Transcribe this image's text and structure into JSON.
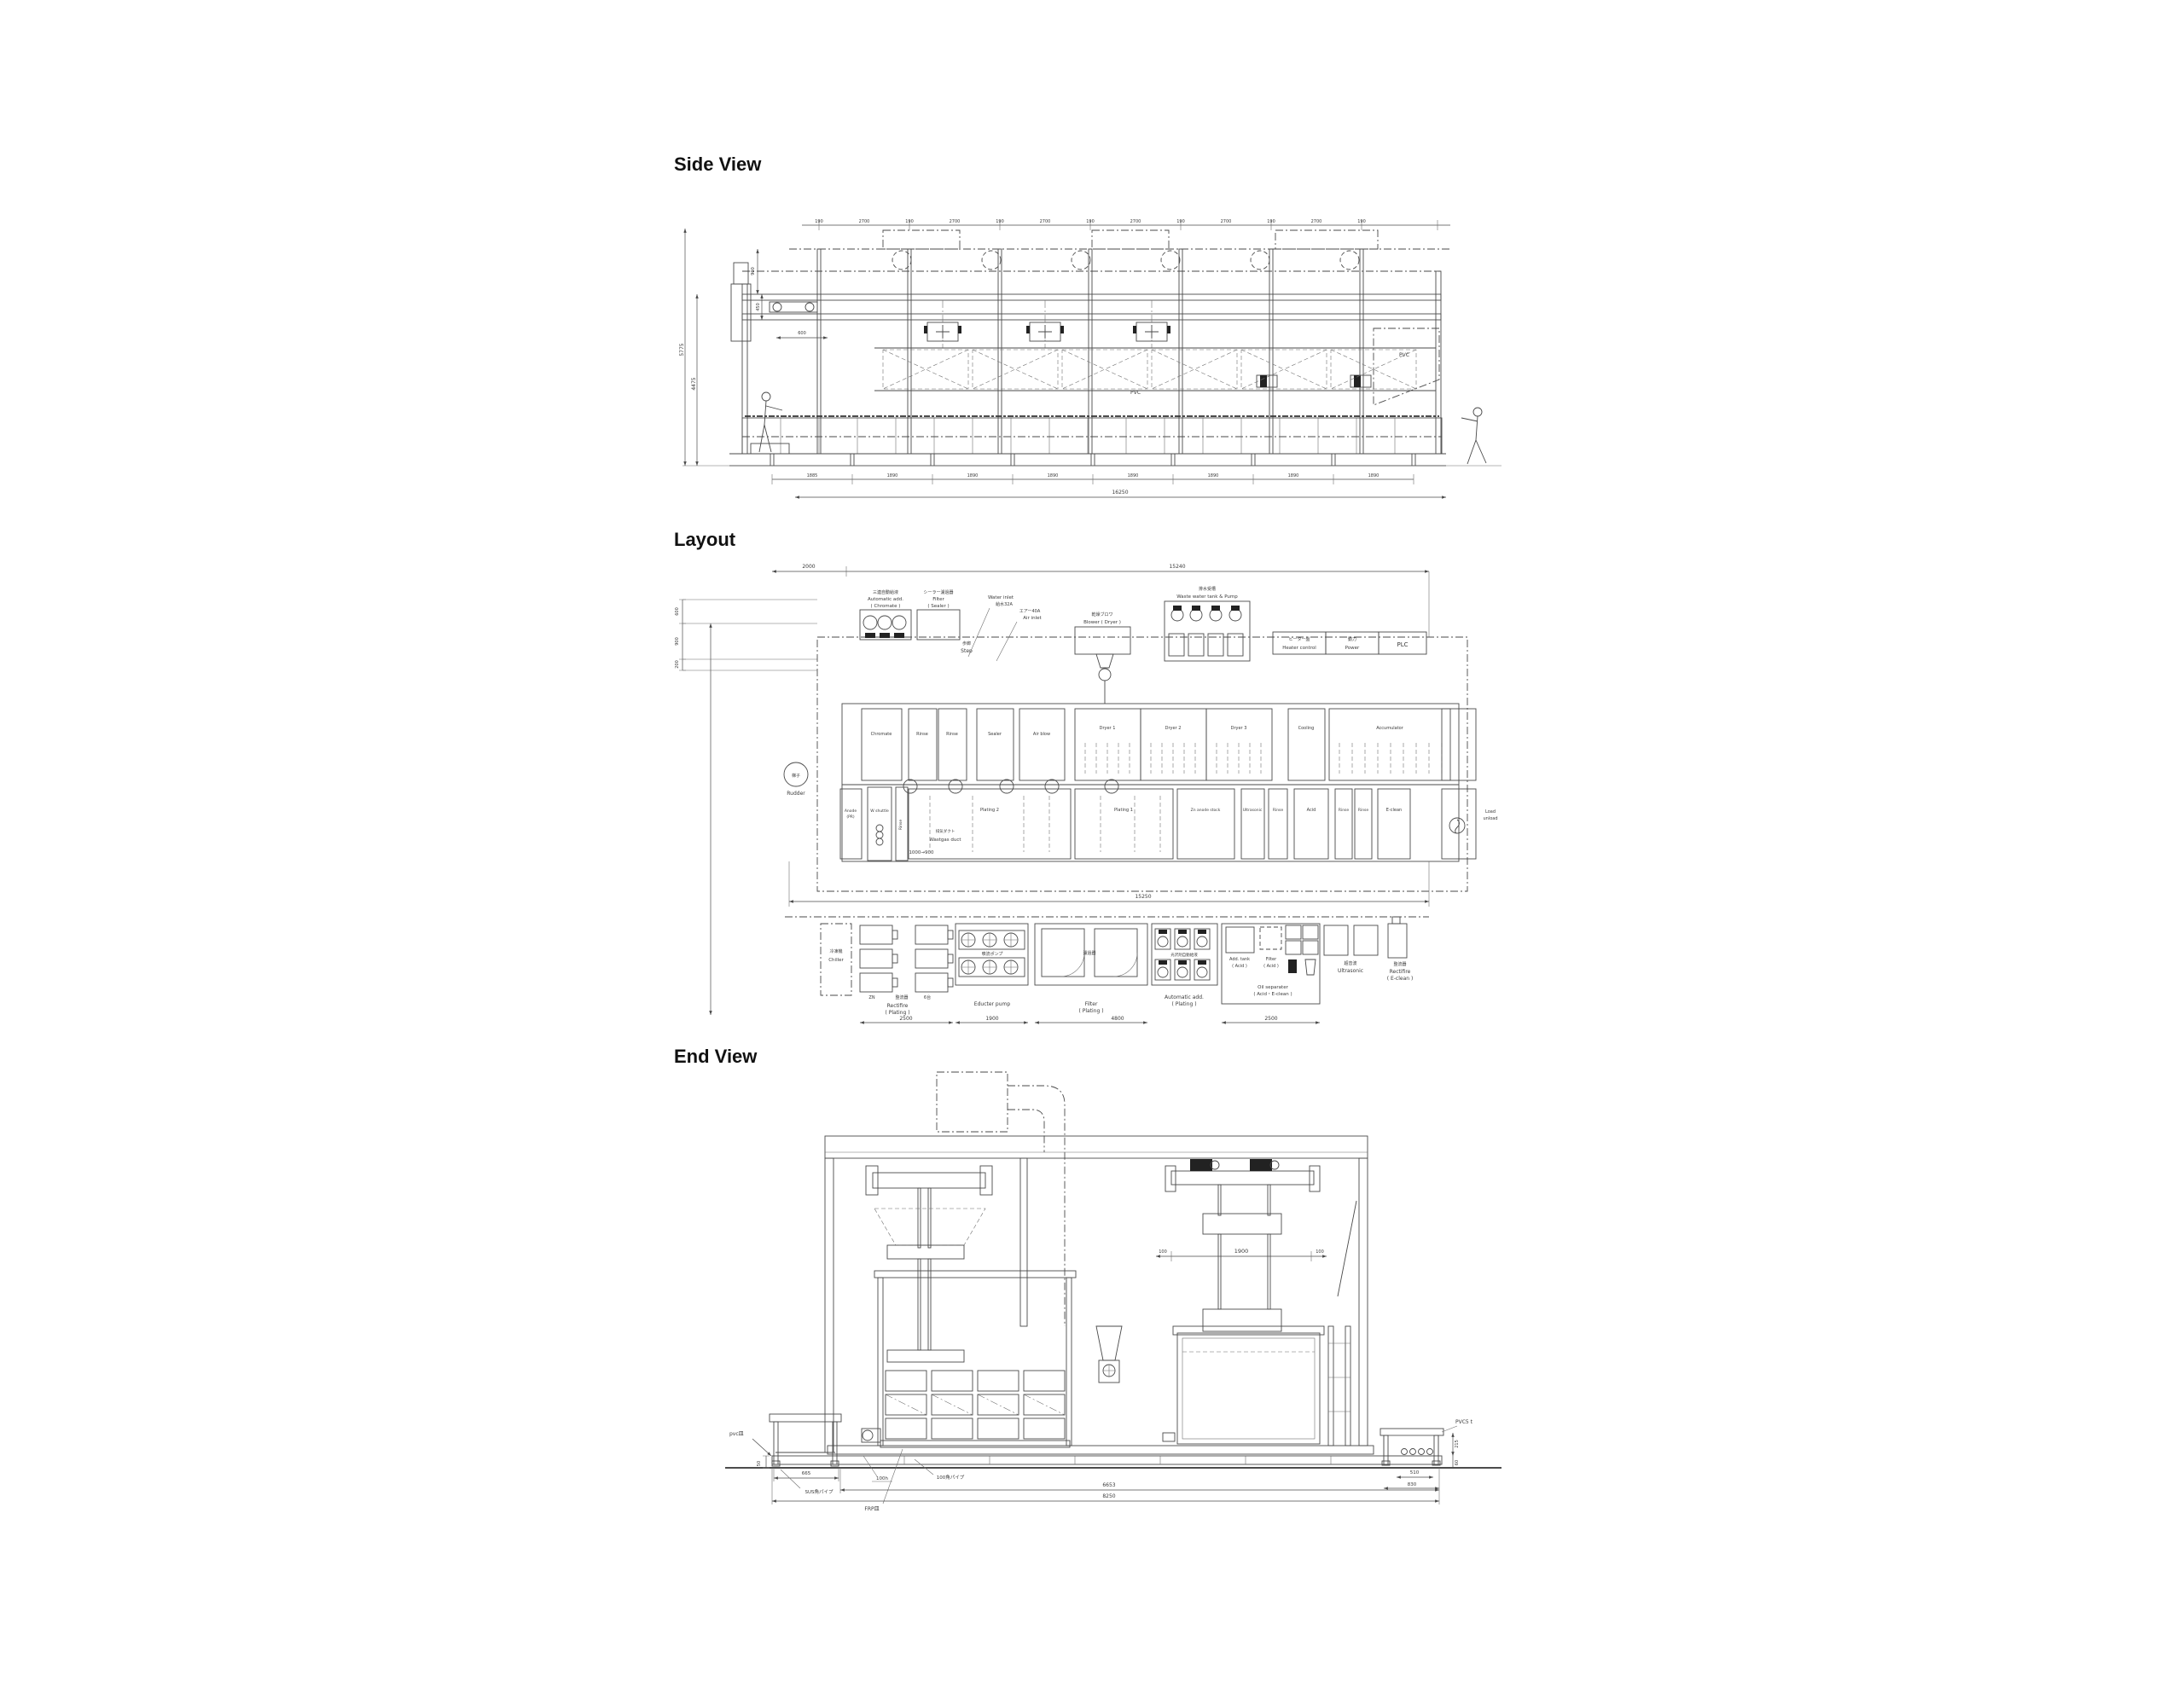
{
  "page": {
    "background": "#ffffff",
    "line_color": "#4a4a4a"
  },
  "side_view": {
    "title": "Side View",
    "dims": {
      "col": "190",
      "bay": "2700",
      "overall_h": "5775",
      "inner_h": "4475",
      "roof_h": "900",
      "beam_h": "450",
      "offset_w": "600",
      "bay_b_first": "1885",
      "bay_b": "1890",
      "overall_w": "16250"
    },
    "labels": {
      "pvc": "PVC"
    }
  },
  "layout": {
    "title": "Layout",
    "dims": {
      "left_offset": "2000",
      "overall_top": "15240",
      "overall_bottom": "15250",
      "v1": "600",
      "v2": "900",
      "v3": "200",
      "duct": "1000→900",
      "rectifier_w": "2500",
      "educter_w": "1900",
      "filter_w": "4800",
      "acid_w": "2500"
    },
    "equipment_top": {
      "auto_add_chromate": {
        "jp": "三連自動給液",
        "en1": "Automatic add.",
        "en2": "( Chromate )"
      },
      "filter_sealer": {
        "jp": "シーラー濾過器",
        "en1": "Filter",
        "en2": "( Sealer )"
      },
      "water_inlet": {
        "en": "Water inlet",
        "jp": "給水32A"
      },
      "air_inlet": {
        "jp": "エアー40A",
        "en": "Air inlet"
      },
      "blower": {
        "jp": "乾燥ブロワ",
        "en": "Blower ( Dryer )"
      },
      "waste_water": {
        "jp": "排水受槽",
        "en": "Waste water tank & Pump"
      },
      "heater": {
        "jp": "ヒーター盤",
        "en": "Heater control"
      },
      "power": {
        "jp": "動力",
        "en": "Power"
      },
      "plc": "PLC",
      "step": {
        "jp": "歩廊",
        "en": "Step"
      },
      "rudder": {
        "jp": "梯子",
        "en": "Rudder"
      }
    },
    "tanks_top": [
      "Chromate",
      "Rinse",
      "Rinse",
      "Sealer",
      "Air blow",
      "Dryer 1",
      "Dryer 2",
      "Dryer 3",
      "Cooling",
      "Accumulator"
    ],
    "tanks_bottom": {
      "anode": {
        "l1": "Anode",
        "l2": "(PR)"
      },
      "shuttle": "W shuttle",
      "rinse0": "Rinse",
      "wastgas": {
        "jp": "排気ダクト",
        "en": "Wastgas duct"
      },
      "plating2": "Plating 2",
      "plating1": "Plating 1",
      "zn_stock": "Zn anode stock",
      "ultrasonic": "Ultrasonic",
      "rinse1": "Rinse",
      "acid": "Acid",
      "rinse2": "Rinse",
      "rinse3": "Rinse",
      "eclean": "E-clean",
      "load": {
        "l1": "Load",
        "l2": "unload"
      }
    },
    "equipment_bottom": {
      "chiller": {
        "jp": "冷凍機",
        "en": "Chiller"
      },
      "rectifier_plating": {
        "sub1": "ZN",
        "sub2": "整流器",
        "sub3": "6台",
        "en1": "Rectifire",
        "en2": "( Plating )"
      },
      "educter": {
        "jp": "噴流ポンプ",
        "en": "Educter pump"
      },
      "filter_plating": {
        "jp": "濾過器",
        "en1": "Filter",
        "en2": "( Plating )"
      },
      "auto_add_plating": {
        "jp": "光沢剤自動給液",
        "en1": "Automatic add.",
        "en2": "( Plating )"
      },
      "add_tank_acid": {
        "en1": "Add. tank",
        "en2": "( Acid )"
      },
      "filter_acid": {
        "en1": "Filter",
        "en2": "( Acid )"
      },
      "oil_separater": {
        "en1": "Oil separater",
        "en2": "( Acid・E-clean )"
      },
      "ultrasonic": {
        "jp": "超音波",
        "en": "Ultrasonic"
      },
      "rectifier_eclean": {
        "jp": "整流器",
        "en1": "Rectifire",
        "en2": "( E-clean )"
      }
    }
  },
  "end_view": {
    "title": "End View",
    "dims": {
      "carrier": "1900",
      "carrier_side": "100",
      "stand_h": "215",
      "stand_base_h": "60",
      "stand_w1": "510",
      "stand_w2": "830",
      "left_h": "50",
      "left_w": "665",
      "mid_w": "6653",
      "overall_w": "8250"
    },
    "labels": {
      "pvc5t": "PVC5 t",
      "pvc_pan": "pvc皿",
      "frp_pan": "FRP皿",
      "sus_pipe": "SUS角パイプ",
      "pipe100": "100角パイプ",
      "h100": "100h"
    }
  }
}
